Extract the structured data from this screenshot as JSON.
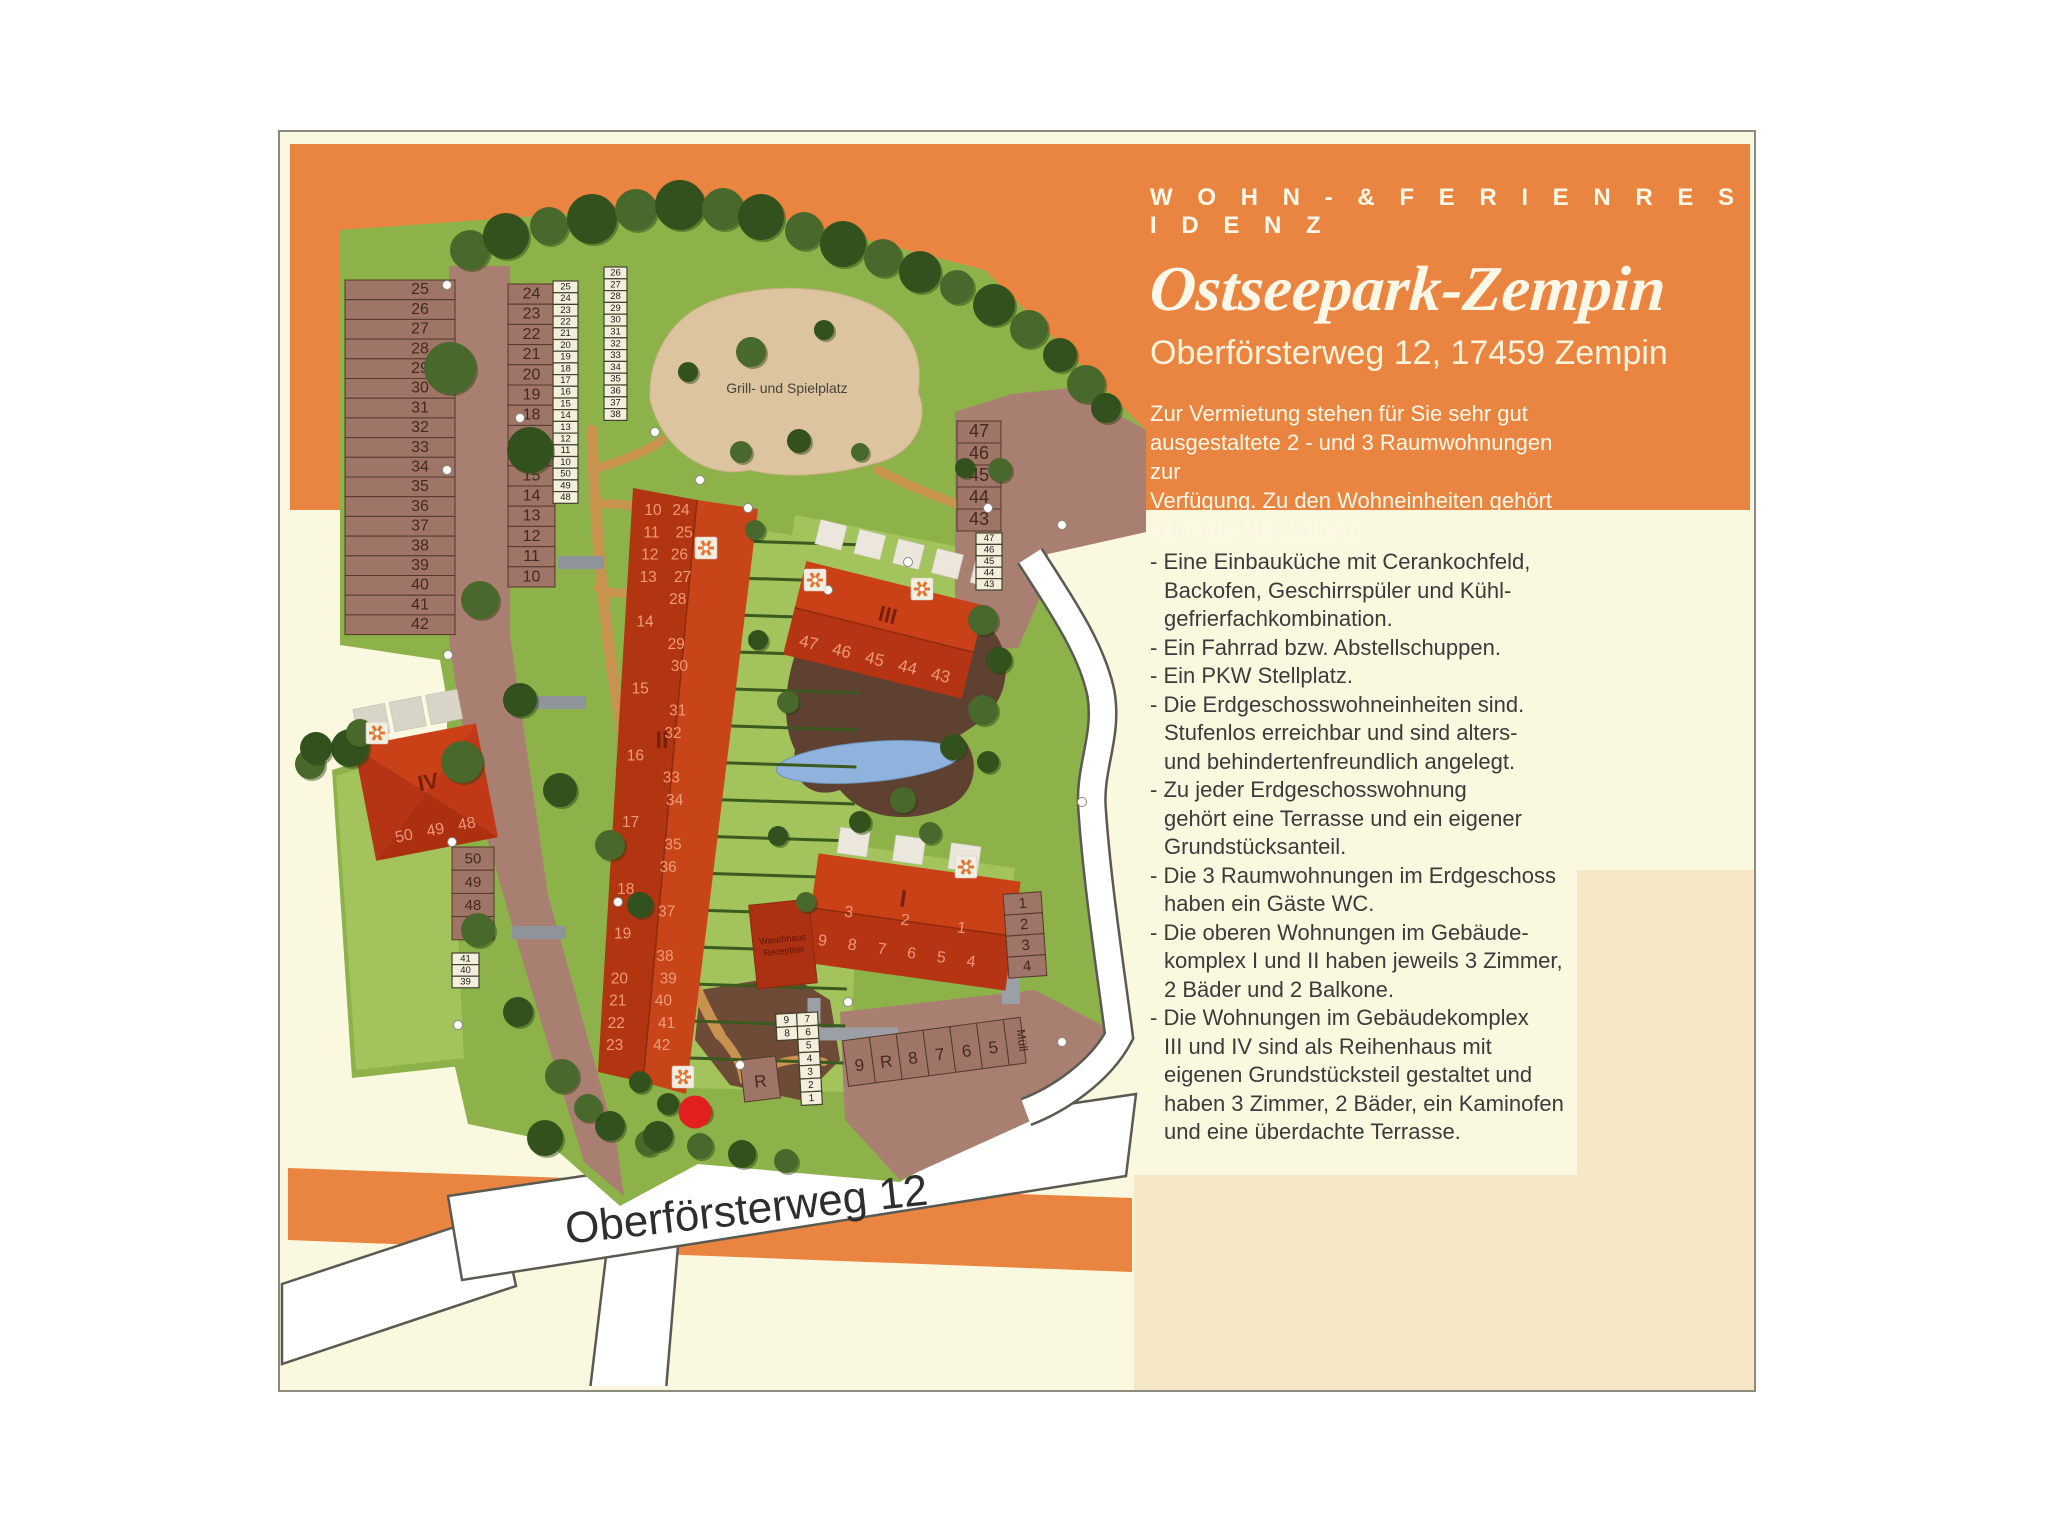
{
  "header": {
    "eyebrow": "W O H N  -  &  F E R I E N R E S I D E N Z",
    "title": "Ostseepark-Zempin",
    "address": "Oberförsterweg 12, 17459 Zempin",
    "intro": "Zur Vermietung stehen für Sie sehr gut\nausgestaltete 2 - und 3 Raumwohnungen zur\nVerfügung. Zu den Wohneinheiten gehört\nfolgende Ausstattung:"
  },
  "features": [
    "- Eine Einbauküche mit Cerankochfeld,\nBackofen, Geschirrspüler und Kühl-\ngefrierfachkombination.",
    "- Ein Fahrrad bzw. Abstellschuppen.",
    "- Ein PKW Stellplatz.",
    "- Die Erdgeschosswohneinheiten sind.\nStufenlos erreichbar und sind alters-\nund behindertenfreundlich angelegt.",
    "- Zu jeder Erdgeschosswohnung\ngehört eine Terrasse und ein eigener\nGrundstücksanteil.",
    "- Die 3 Raumwohnungen im Erdgeschoss\nhaben ein Gäste WC.",
    "- Die oberen Wohnungen im Gebäude-\nkomplex I und II haben jeweils 3 Zimmer,\n2 Bäder und 2 Balkone.",
    "- Die Wohnungen im Gebäudekomplex\nIII und IV sind als Reihenhaus mit\neigenen Grundstücksteil gestaltet und\nhaben 3 Zimmer, 2 Bäder, ein Kaminofen\nund eine überdachte Terrasse."
  ],
  "map": {
    "street_label": "Oberförsterweg 12",
    "playground_label": "Grill- und Spielplatz",
    "washhouse_lines": [
      "Waschhaus",
      "Reception"
    ],
    "building_labels": {
      "b1": "I",
      "b2": "II",
      "b3": "III",
      "b4": "IV"
    },
    "b1_top": [
      "3",
      "2",
      "1"
    ],
    "b1_bottom": [
      "9",
      "8",
      "7",
      "6",
      "5",
      "4"
    ],
    "b3_nums": [
      "47",
      "46",
      "45",
      "44",
      "43"
    ],
    "b4_nums": [
      "50",
      "49",
      "48"
    ],
    "b2_rows": [
      [
        "10",
        "24"
      ],
      [
        "11",
        "25"
      ],
      [
        "12",
        "26"
      ],
      [
        "13",
        "27"
      ],
      [
        "",
        "28"
      ],
      [
        "14",
        ""
      ],
      [
        "",
        "29"
      ],
      [
        "",
        "30"
      ],
      [
        "15",
        ""
      ],
      [
        "",
        "31"
      ],
      [
        "",
        "32"
      ],
      [
        "16",
        ""
      ],
      [
        "",
        "33"
      ],
      [
        "",
        "34"
      ],
      [
        "17",
        ""
      ],
      [
        "",
        "35"
      ],
      [
        "",
        "36"
      ],
      [
        "18",
        ""
      ],
      [
        "",
        "37"
      ],
      [
        "19",
        ""
      ],
      [
        "",
        "38"
      ],
      [
        "20",
        "39"
      ],
      [
        "21",
        "40"
      ],
      [
        "22",
        "41"
      ],
      [
        "23",
        "42"
      ]
    ],
    "parking": {
      "left_col": [
        "25",
        "26",
        "27",
        "28",
        "29",
        "30",
        "31",
        "32",
        "33",
        "34",
        "35",
        "36",
        "37",
        "38",
        "39",
        "40",
        "41",
        "42"
      ],
      "mid_col": [
        "24",
        "23",
        "22",
        "21",
        "20",
        "19",
        "18",
        "17",
        "16",
        "15",
        "14",
        "13",
        "12",
        "11",
        "10"
      ],
      "labels_a": [
        "25",
        "24",
        "23",
        "22",
        "21",
        "20",
        "19",
        "18",
        "17",
        "16",
        "15",
        "14",
        "13",
        "12",
        "11",
        "10",
        "50",
        "49",
        "48"
      ],
      "labels_b": [
        "26",
        "27",
        "28",
        "29",
        "30",
        "31",
        "32",
        "33",
        "34",
        "35",
        "36",
        "37",
        "38"
      ],
      "ne_stalls": [
        "47",
        "46",
        "45",
        "44",
        "43"
      ],
      "ne_labels": [
        "47",
        "46",
        "45",
        "44",
        "43"
      ],
      "east_stalls": [
        "1",
        "2",
        "3",
        "4"
      ],
      "south_row": [
        "9",
        "R",
        "8",
        "7",
        "6",
        "5"
      ],
      "south_muell": "Müll",
      "grid_left": [
        "9",
        "8"
      ],
      "grid_right": [
        "7",
        "6",
        "5",
        "4",
        "3",
        "2",
        "1"
      ],
      "iv_stalls": [
        "50",
        "49",
        "48"
      ],
      "iv_muell": "Müll",
      "iv_labels": [
        "41",
        "40",
        "39"
      ],
      "r_stall": "R"
    },
    "colors": {
      "accent_orange": "#E98540",
      "cream": "#FAF8DF",
      "beige": "#F6E8C6",
      "site_green": "#8DB24A",
      "plot_green": "#A3C35C",
      "road_brown": "#A87F70",
      "building_red": "#C23A18",
      "sand": "#DCC49E",
      "pond_blue": "#8FB3DC",
      "street_white": "#FFFFFF",
      "marker_red": "#E2201F"
    }
  }
}
